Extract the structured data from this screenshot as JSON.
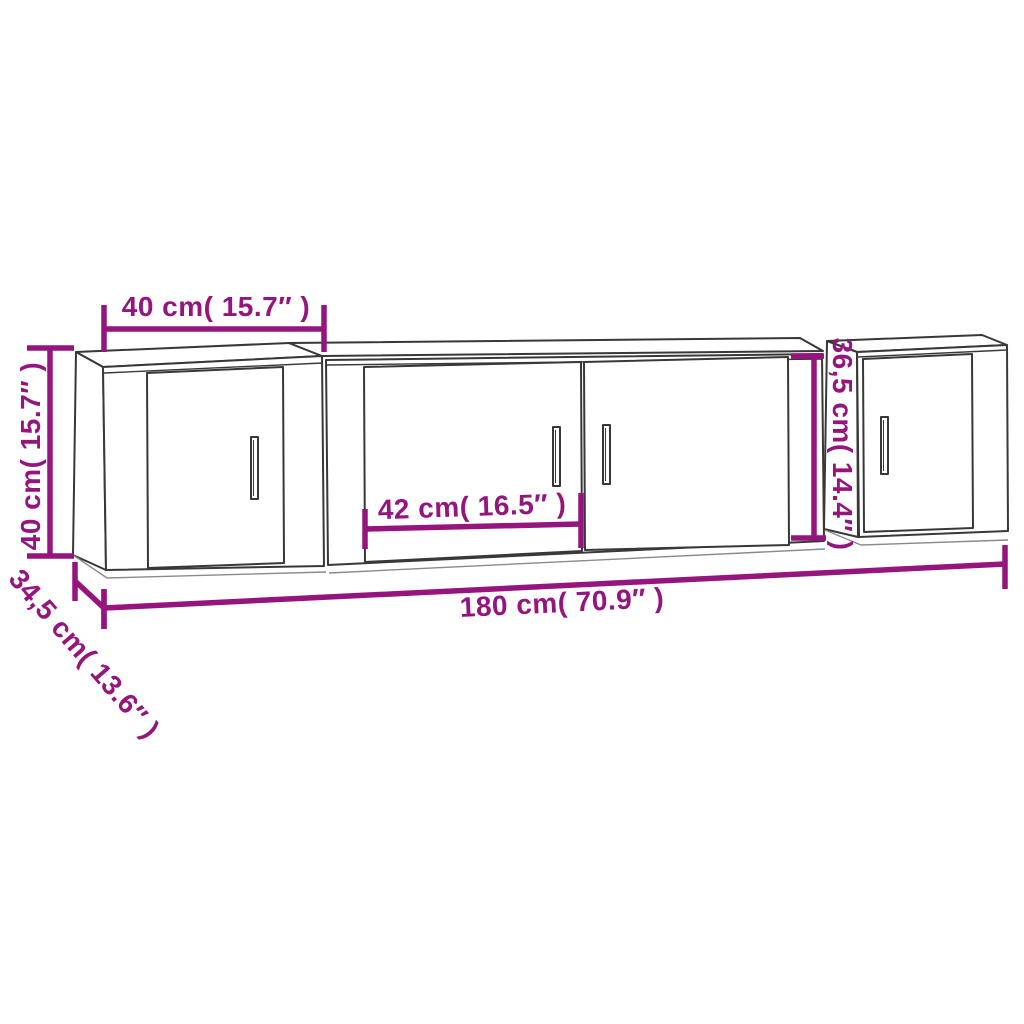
{
  "diagram": {
    "description": "Dimension diagram of a 3-piece wall-mounted TV cabinet set",
    "colors": {
      "dimension_accent": "#96147e",
      "line_art": "#383838",
      "line_art_light": "#8a8a8a",
      "background": "#ffffff"
    },
    "labels": {
      "left_cabinet_width": "40 cm( 15.7″ )",
      "left_cabinet_height": "40 cm( 15.7″ )",
      "cabinet_depth": "34,5 cm( 13.6″ )",
      "center_door_width": "42 cm( 16.5″ )",
      "total_width": "180 cm( 70.9″ )",
      "center_cabinet_height": "36,5 cm( 14.4″ )"
    }
  }
}
